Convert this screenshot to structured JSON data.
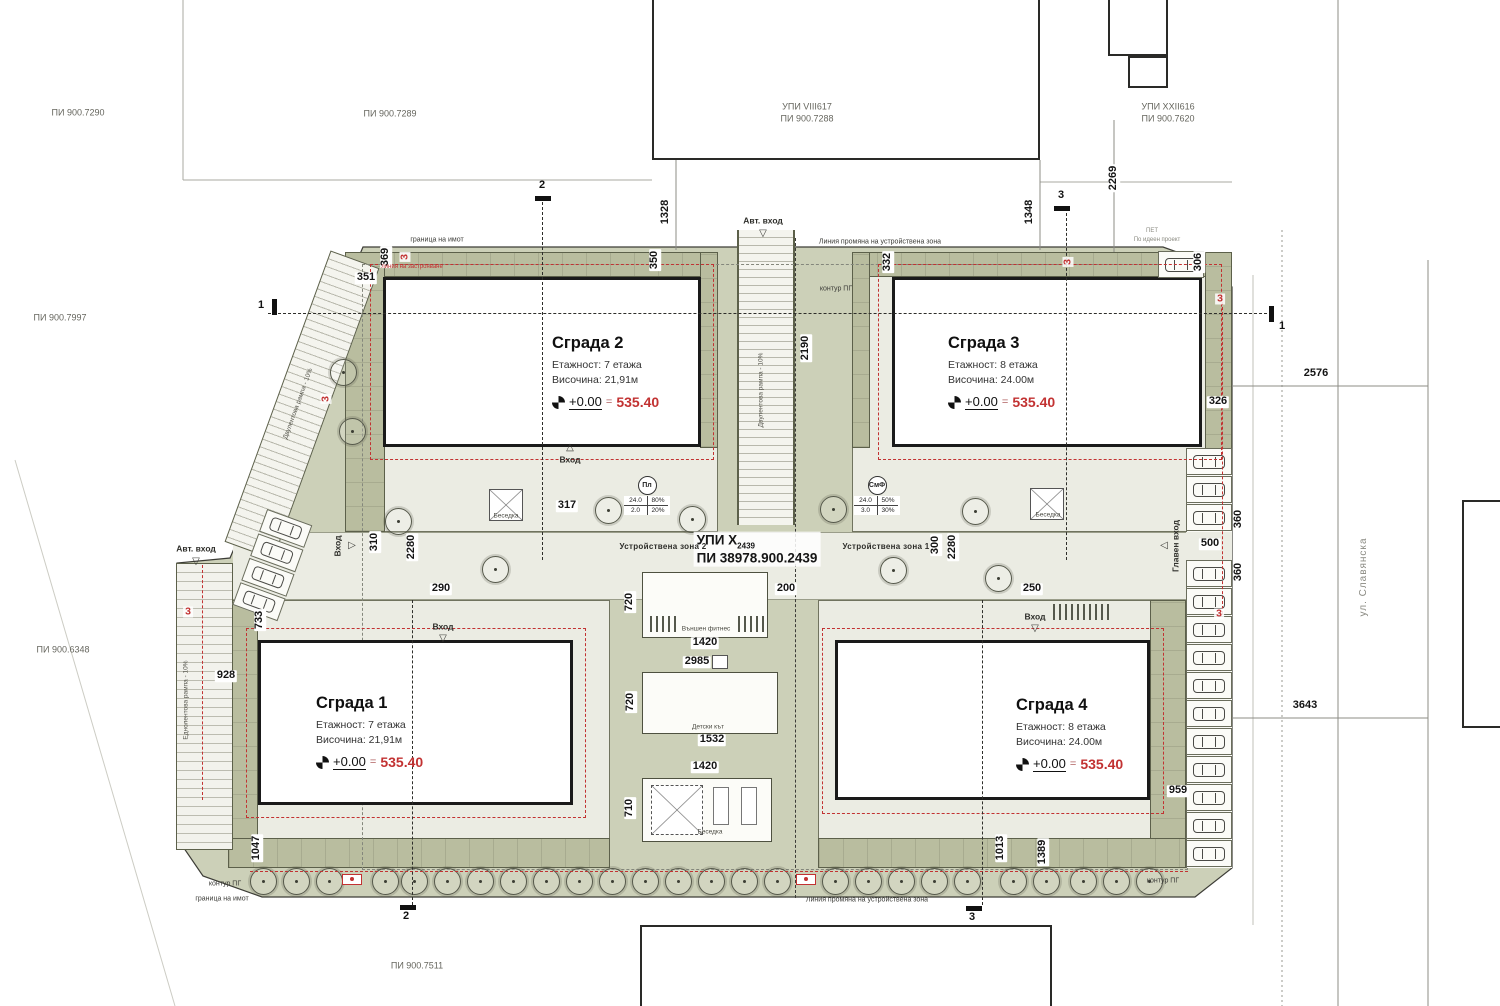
{
  "colors": {
    "site": "#ccd0b8",
    "band": "#b9bd9f",
    "band_line": "#5c604a",
    "court": "#ebece3",
    "ink": "#1a1a1a",
    "red": "#c23232"
  },
  "buildings": [
    {
      "name": "Сграда 1",
      "floors": "Етажност: 7 етажа",
      "height": "Височина: 21,91м",
      "level": "+0.00",
      "eq": "=",
      "value": "535.40"
    },
    {
      "name": "Сграда 2",
      "floors": "Етажност: 7 етажа",
      "height": "Височина: 21,91м",
      "level": "+0.00",
      "eq": "=",
      "value": "535.40"
    },
    {
      "name": "Сграда 3",
      "floors": "Етажност: 8 етажа",
      "height": "Височина: 24.00м",
      "level": "+0.00",
      "eq": "=",
      "value": "535.40"
    },
    {
      "name": "Сграда 4",
      "floors": "Етажност: 8 етажа",
      "height": "Височина: 24.00м",
      "level": "+0.00",
      "eq": "=",
      "value": "535.40"
    }
  ],
  "center": {
    "upi": "УПИ X",
    "upi_sub": "2439",
    "pi": "ПИ 38978.900.2439"
  },
  "tables": [
    {
      "symbol": "Пл",
      "a": "24.0",
      "b": "80%",
      "c": "2.0",
      "d": "20%"
    },
    {
      "symbol": "СмФ",
      "a": "24.0",
      "b": "50%",
      "c": "3.0",
      "d": "30%"
    }
  ],
  "annotations": [
    {
      "t": "369",
      "x": 386,
      "y": 257,
      "r": -90,
      "c": "dim"
    },
    {
      "t": "351",
      "x": 366,
      "y": 278,
      "c": "dim"
    },
    {
      "t": "350",
      "x": 655,
      "y": 260,
      "r": -90,
      "c": "dim"
    },
    {
      "t": "332",
      "x": 888,
      "y": 262,
      "r": -90,
      "c": "dim"
    },
    {
      "t": "306",
      "x": 1199,
      "y": 262,
      "r": -90,
      "c": "dim"
    },
    {
      "t": "1328",
      "x": 666,
      "y": 212,
      "r": -90,
      "c": "dim"
    },
    {
      "t": "1348",
      "x": 1030,
      "y": 212,
      "r": -90,
      "c": "dim"
    },
    {
      "t": "2269",
      "x": 1114,
      "y": 178,
      "r": -90,
      "c": "dim"
    },
    {
      "t": "2190",
      "x": 806,
      "y": 348,
      "r": -90,
      "c": "dim"
    },
    {
      "t": "317",
      "x": 567,
      "y": 506,
      "c": "dim"
    },
    {
      "t": "310",
      "x": 375,
      "y": 542,
      "r": -90,
      "c": "dim"
    },
    {
      "t": "2280",
      "x": 412,
      "y": 547,
      "r": -90,
      "c": "dim"
    },
    {
      "t": "290",
      "x": 441,
      "y": 589,
      "c": "dim"
    },
    {
      "t": "300",
      "x": 936,
      "y": 545,
      "r": -90,
      "c": "dim"
    },
    {
      "t": "2280",
      "x": 953,
      "y": 547,
      "r": -90,
      "c": "dim"
    },
    {
      "t": "250",
      "x": 1032,
      "y": 589,
      "c": "dim"
    },
    {
      "t": "200",
      "x": 786,
      "y": 589,
      "c": "dim"
    },
    {
      "t": "720",
      "x": 630,
      "y": 602,
      "r": -90,
      "c": "dim"
    },
    {
      "t": "1420",
      "x": 705,
      "y": 643,
      "c": "dim"
    },
    {
      "t": "2985",
      "x": 697,
      "y": 662,
      "c": "dim"
    },
    {
      "t": "720",
      "x": 631,
      "y": 702,
      "r": -90,
      "c": "dim"
    },
    {
      "t": "1532",
      "x": 712,
      "y": 740,
      "c": "dim"
    },
    {
      "t": "1420",
      "x": 705,
      "y": 767,
      "c": "dim"
    },
    {
      "t": "710",
      "x": 630,
      "y": 808,
      "r": -90,
      "c": "dim"
    },
    {
      "t": "326",
      "x": 1218,
      "y": 402,
      "c": "dim"
    },
    {
      "t": "360",
      "x": 1239,
      "y": 519,
      "r": -90,
      "c": "dim"
    },
    {
      "t": "500",
      "x": 1210,
      "y": 544,
      "c": "dim"
    },
    {
      "t": "360",
      "x": 1239,
      "y": 572,
      "r": -90,
      "c": "dim"
    },
    {
      "t": "2576",
      "x": 1316,
      "y": 374,
      "c": "dim"
    },
    {
      "t": "3643",
      "x": 1305,
      "y": 706,
      "c": "dim"
    },
    {
      "t": "959",
      "x": 1178,
      "y": 791,
      "c": "dim"
    },
    {
      "t": "733",
      "x": 260,
      "y": 620,
      "r": -90,
      "c": "dim"
    },
    {
      "t": "928",
      "x": 226,
      "y": 676,
      "c": "dim"
    },
    {
      "t": "1047",
      "x": 257,
      "y": 848,
      "r": -90,
      "c": "dim"
    },
    {
      "t": "1013",
      "x": 1001,
      "y": 848,
      "r": -90,
      "c": "dim"
    },
    {
      "t": "1389",
      "x": 1043,
      "y": 852,
      "r": -90,
      "c": "dim"
    },
    {
      "t": "3",
      "x": 405,
      "y": 257,
      "r": -90,
      "c": "red3"
    },
    {
      "t": "3",
      "x": 1068,
      "y": 262,
      "r": -90,
      "c": "red3"
    },
    {
      "t": "3",
      "x": 1220,
      "y": 299,
      "c": "red3"
    },
    {
      "t": "3",
      "x": 326,
      "y": 399,
      "r": -90,
      "c": "red3"
    },
    {
      "t": "3",
      "x": 188,
      "y": 612,
      "c": "red3"
    },
    {
      "t": "3",
      "x": 1219,
      "y": 614,
      "c": "red3"
    },
    {
      "t": "граница на имот",
      "x": 437,
      "y": 240,
      "c": "tiny"
    },
    {
      "t": "граница на имот",
      "x": 222,
      "y": 899,
      "c": "tiny"
    },
    {
      "t": "контур ПГ",
      "x": 836,
      "y": 289,
      "c": "tiny"
    },
    {
      "t": "контур ПГ",
      "x": 225,
      "y": 884,
      "c": "tiny"
    },
    {
      "t": "контур ПГ",
      "x": 1163,
      "y": 881,
      "c": "tiny"
    },
    {
      "t": "Линия промяна на устройствена зона",
      "x": 880,
      "y": 242,
      "c": "tiny"
    },
    {
      "t": "Линия промяна на устройствена зона",
      "x": 867,
      "y": 900,
      "c": "tiny"
    },
    {
      "t": "линия на застрояване",
      "x": 412,
      "y": 267,
      "c": "redtiny"
    },
    {
      "t": "Устройствена зона 2",
      "x": 663,
      "y": 547,
      "c": "zone"
    },
    {
      "t": "Устройствена зона 1",
      "x": 886,
      "y": 547,
      "c": "zone"
    },
    {
      "t": "Външен фитнес",
      "x": 706,
      "y": 630,
      "c": "amenl"
    },
    {
      "t": "Детски кът",
      "x": 708,
      "y": 728,
      "c": "amenl"
    },
    {
      "t": "Беседка",
      "x": 710,
      "y": 833,
      "c": "amenl"
    },
    {
      "t": "Беседка",
      "x": 506,
      "y": 517,
      "c": "amenl"
    },
    {
      "t": "Беседка",
      "x": 1048,
      "y": 516,
      "c": "amenl"
    },
    {
      "t": "ПИ 900.7290",
      "x": 78,
      "y": 113,
      "c": "parcel"
    },
    {
      "t": "ПИ 900.7289",
      "x": 390,
      "y": 114,
      "c": "parcel"
    },
    {
      "t": "УПИ VIII617",
      "x": 807,
      "y": 107,
      "c": "parcel"
    },
    {
      "t": "ПИ 900.7288",
      "x": 807,
      "y": 119,
      "c": "parcel"
    },
    {
      "t": "УПИ XXII616",
      "x": 1168,
      "y": 107,
      "c": "parcel"
    },
    {
      "t": "ПИ 900.7620",
      "x": 1168,
      "y": 119,
      "c": "parcel"
    },
    {
      "t": "ПИ 900.7997",
      "x": 60,
      "y": 318,
      "c": "parcel"
    },
    {
      "t": "ПИ 900.6348",
      "x": 63,
      "y": 650,
      "c": "parcel"
    },
    {
      "t": "ПИ 900.7511",
      "x": 417,
      "y": 966,
      "c": "parcel"
    },
    {
      "t": "ПЕТ",
      "x": 1152,
      "y": 231,
      "c": "micro"
    },
    {
      "t": "По идеен проект",
      "x": 1157,
      "y": 240,
      "c": "micro"
    },
    {
      "t": "ул. Славянска",
      "x": 1364,
      "y": 577,
      "r": -90,
      "c": "street"
    },
    {
      "t": "Двулентова рампа - 10%",
      "x": 762,
      "y": 390,
      "r": -90,
      "c": "rampl"
    },
    {
      "t": "Двулентова рампа - 10%",
      "x": 299,
      "y": 404,
      "r": -70,
      "c": "rampl"
    },
    {
      "t": "Еднолентова рампа - 10%",
      "x": 187,
      "y": 700,
      "r": -90,
      "c": "rampl"
    }
  ],
  "entrances": [
    {
      "t": "Авт. вход",
      "x": 763,
      "y": 221,
      "tx": 763,
      "ty": 234,
      "dir": "down"
    },
    {
      "t": "Авт. вход",
      "x": 196,
      "y": 549,
      "tx": 196,
      "ty": 562,
      "dir": "down"
    },
    {
      "t": "Главен вход",
      "x": 1176,
      "y": 546,
      "r": -90,
      "tx": 1164,
      "ty": 546,
      "dir": "left"
    },
    {
      "t": "Вход",
      "x": 570,
      "y": 460,
      "tx": 570,
      "ty": 448,
      "dir": "up"
    },
    {
      "t": "Вход",
      "x": 338,
      "y": 546,
      "r": -90,
      "tx": 352,
      "ty": 546,
      "dir": "right"
    },
    {
      "t": "Вход",
      "x": 443,
      "y": 627,
      "tx": 443,
      "ty": 639,
      "dir": "down"
    },
    {
      "t": "Вход",
      "x": 1035,
      "y": 617,
      "tx": 1035,
      "ty": 629,
      "dir": "down"
    }
  ],
  "sections": [
    {
      "n": "2",
      "x": 542,
      "y": 186,
      "bx": 535,
      "by": 196,
      "o": "h"
    },
    {
      "n": "2",
      "x": 406,
      "y": 917,
      "bx": 400,
      "by": 905,
      "o": "h"
    },
    {
      "n": "3",
      "x": 1061,
      "y": 196,
      "bx": 1054,
      "by": 206,
      "o": "h"
    },
    {
      "n": "3",
      "x": 972,
      "y": 918,
      "bx": 966,
      "by": 906,
      "o": "h"
    },
    {
      "n": "1",
      "x": 261,
      "y": 306,
      "bx": 272,
      "by": 299,
      "o": "v"
    },
    {
      "n": "1",
      "x": 1282,
      "y": 327,
      "bx": 1269,
      "by": 306,
      "o": "v"
    }
  ],
  "trees": {
    "bottom_y": 881,
    "bottom": [
      263,
      296,
      329,
      385,
      414,
      447,
      480,
      513,
      546,
      579,
      612,
      645,
      678,
      711,
      744,
      777,
      835,
      868,
      901,
      934,
      967,
      1013,
      1046,
      1083,
      1116,
      1149
    ],
    "court": [
      [
        398,
        521
      ],
      [
        495,
        569
      ],
      [
        608,
        510
      ],
      [
        692,
        519
      ],
      [
        833,
        509
      ],
      [
        893,
        570
      ],
      [
        975,
        511
      ],
      [
        998,
        578
      ],
      [
        343,
        372
      ],
      [
        352,
        431
      ]
    ]
  },
  "parking": {
    "right": {
      "x": 1186,
      "w": 46,
      "h": 28,
      "groups": [
        {
          "y": 448,
          "n": 3
        },
        {
          "y": 560,
          "n": 11
        }
      ]
    },
    "top": {
      "x": 1158,
      "y": 251
    },
    "left_cluster": {
      "x": 248,
      "y": 514,
      "rot": 20,
      "n": 4
    }
  },
  "racks": [
    [
      1053,
      604,
      10
    ],
    [
      650,
      616,
      5
    ],
    [
      738,
      616,
      5
    ]
  ],
  "hydrants": [
    [
      352,
      879
    ],
    [
      806,
      879
    ]
  ]
}
